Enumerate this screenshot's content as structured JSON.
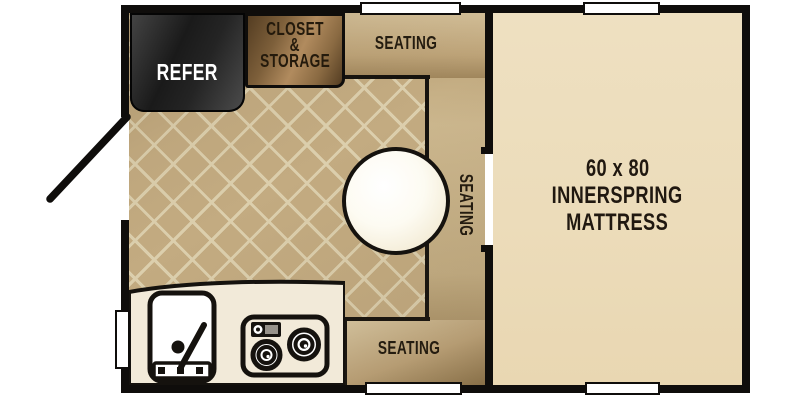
{
  "floorplan": {
    "areas": {
      "refrigerator": {
        "label": "REFER"
      },
      "closet": {
        "label_lines": [
          "CLOSET",
          "&",
          "STORAGE"
        ]
      },
      "dinette": {
        "seating_top_label": "SEATING",
        "seating_right_label": "SEATING",
        "seating_bottom_label": "SEATING"
      },
      "bedroom": {
        "label_lines": [
          "60 x 80",
          "INNERSPRING",
          "MATTRESS"
        ]
      }
    },
    "fixtures": {
      "table": "round-dinette-table",
      "sink": "kitchen-sink",
      "stove": "two-burner-stove",
      "door": "entry-door-swing",
      "windows": [
        "top-left",
        "top-right",
        "bottom-left",
        "bottom-right",
        "side-left"
      ]
    },
    "colors": {
      "wall": "#0f0d0b",
      "floor_tile": "#c3ab81",
      "floor_grout": "#dccfad",
      "bench_light": "#d3bf98",
      "bench_dark": "#8d744b",
      "closet_brown": "#b18b5e",
      "refrigerator_dark": "#1a1a1a",
      "bedroom_floor": "#ecdcba",
      "counter": "#f2ead9",
      "table_fill": "#ffffff",
      "label_dark": "#241c10",
      "label_light": "#ffffff"
    }
  }
}
